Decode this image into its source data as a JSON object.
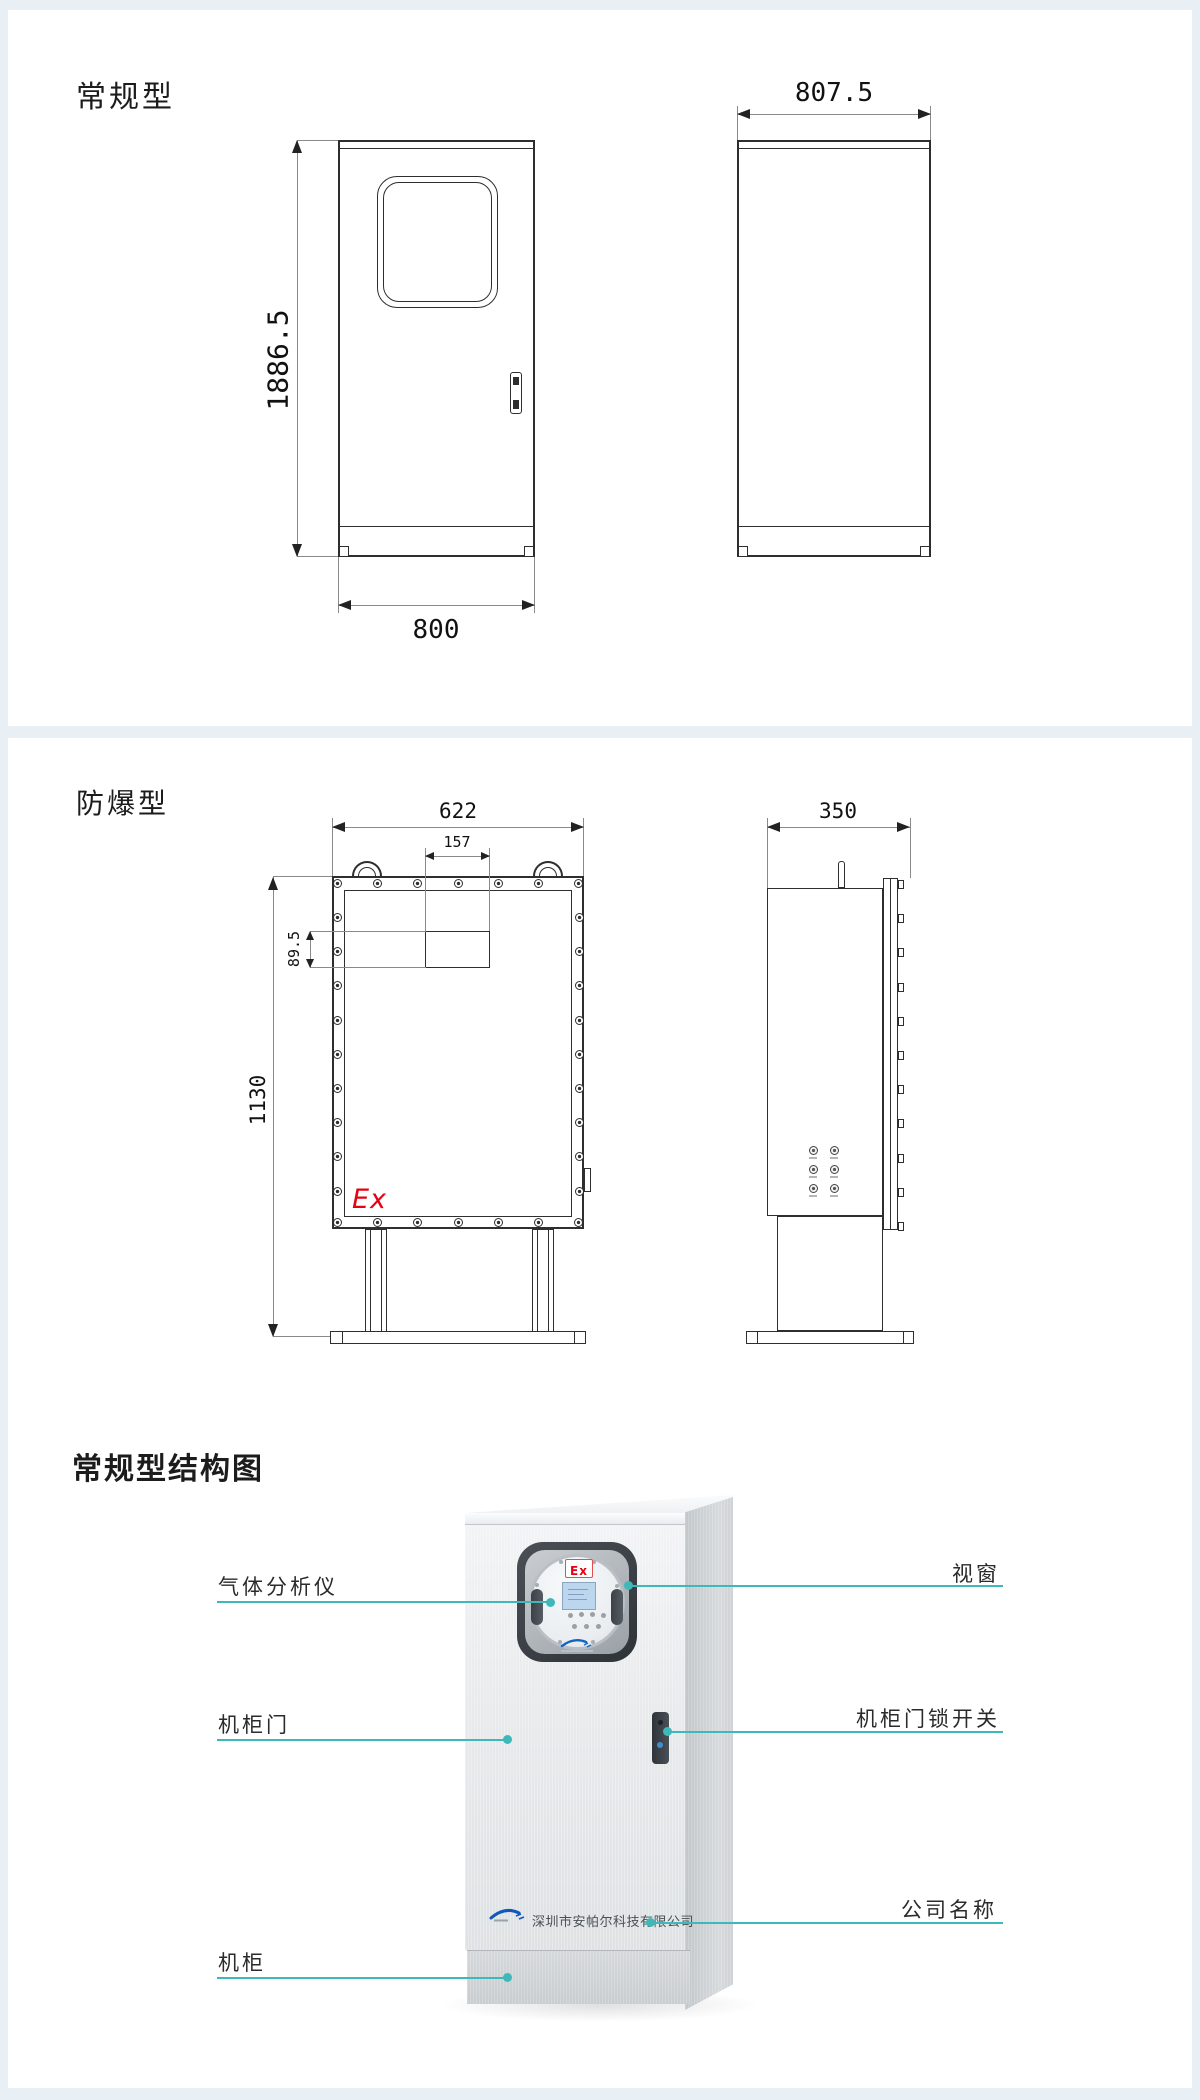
{
  "colors": {
    "accent_teal": "#3FB8BA",
    "ex_red": "#E60012",
    "band_blue": "#E8EFF5",
    "drawing_line": "#2E2E2E"
  },
  "regular": {
    "title": "常规型",
    "front": {
      "height_dim": "1886.5",
      "width_dim": "800"
    },
    "side": {
      "depth_dim": "807.5"
    }
  },
  "explosion": {
    "title": "防爆型",
    "front": {
      "width_dim": "622",
      "gland_box_width_dim": "157",
      "gland_box_height_dim": "89.5",
      "height_dim": "1130",
      "ex_mark": "Ex"
    },
    "side": {
      "depth_dim": "350"
    }
  },
  "structure": {
    "title": "常规型结构图",
    "window_ex_mark": "Ex",
    "company_name": "深圳市安帕尔科技有限公司",
    "callouts": {
      "gas_analyzer": "气体分析仪",
      "window": "视窗",
      "cabinet_door": "机柜门",
      "door_lock_switch": "机柜门锁开关",
      "company_name_label": "公司名称",
      "cabinet": "机柜"
    }
  }
}
